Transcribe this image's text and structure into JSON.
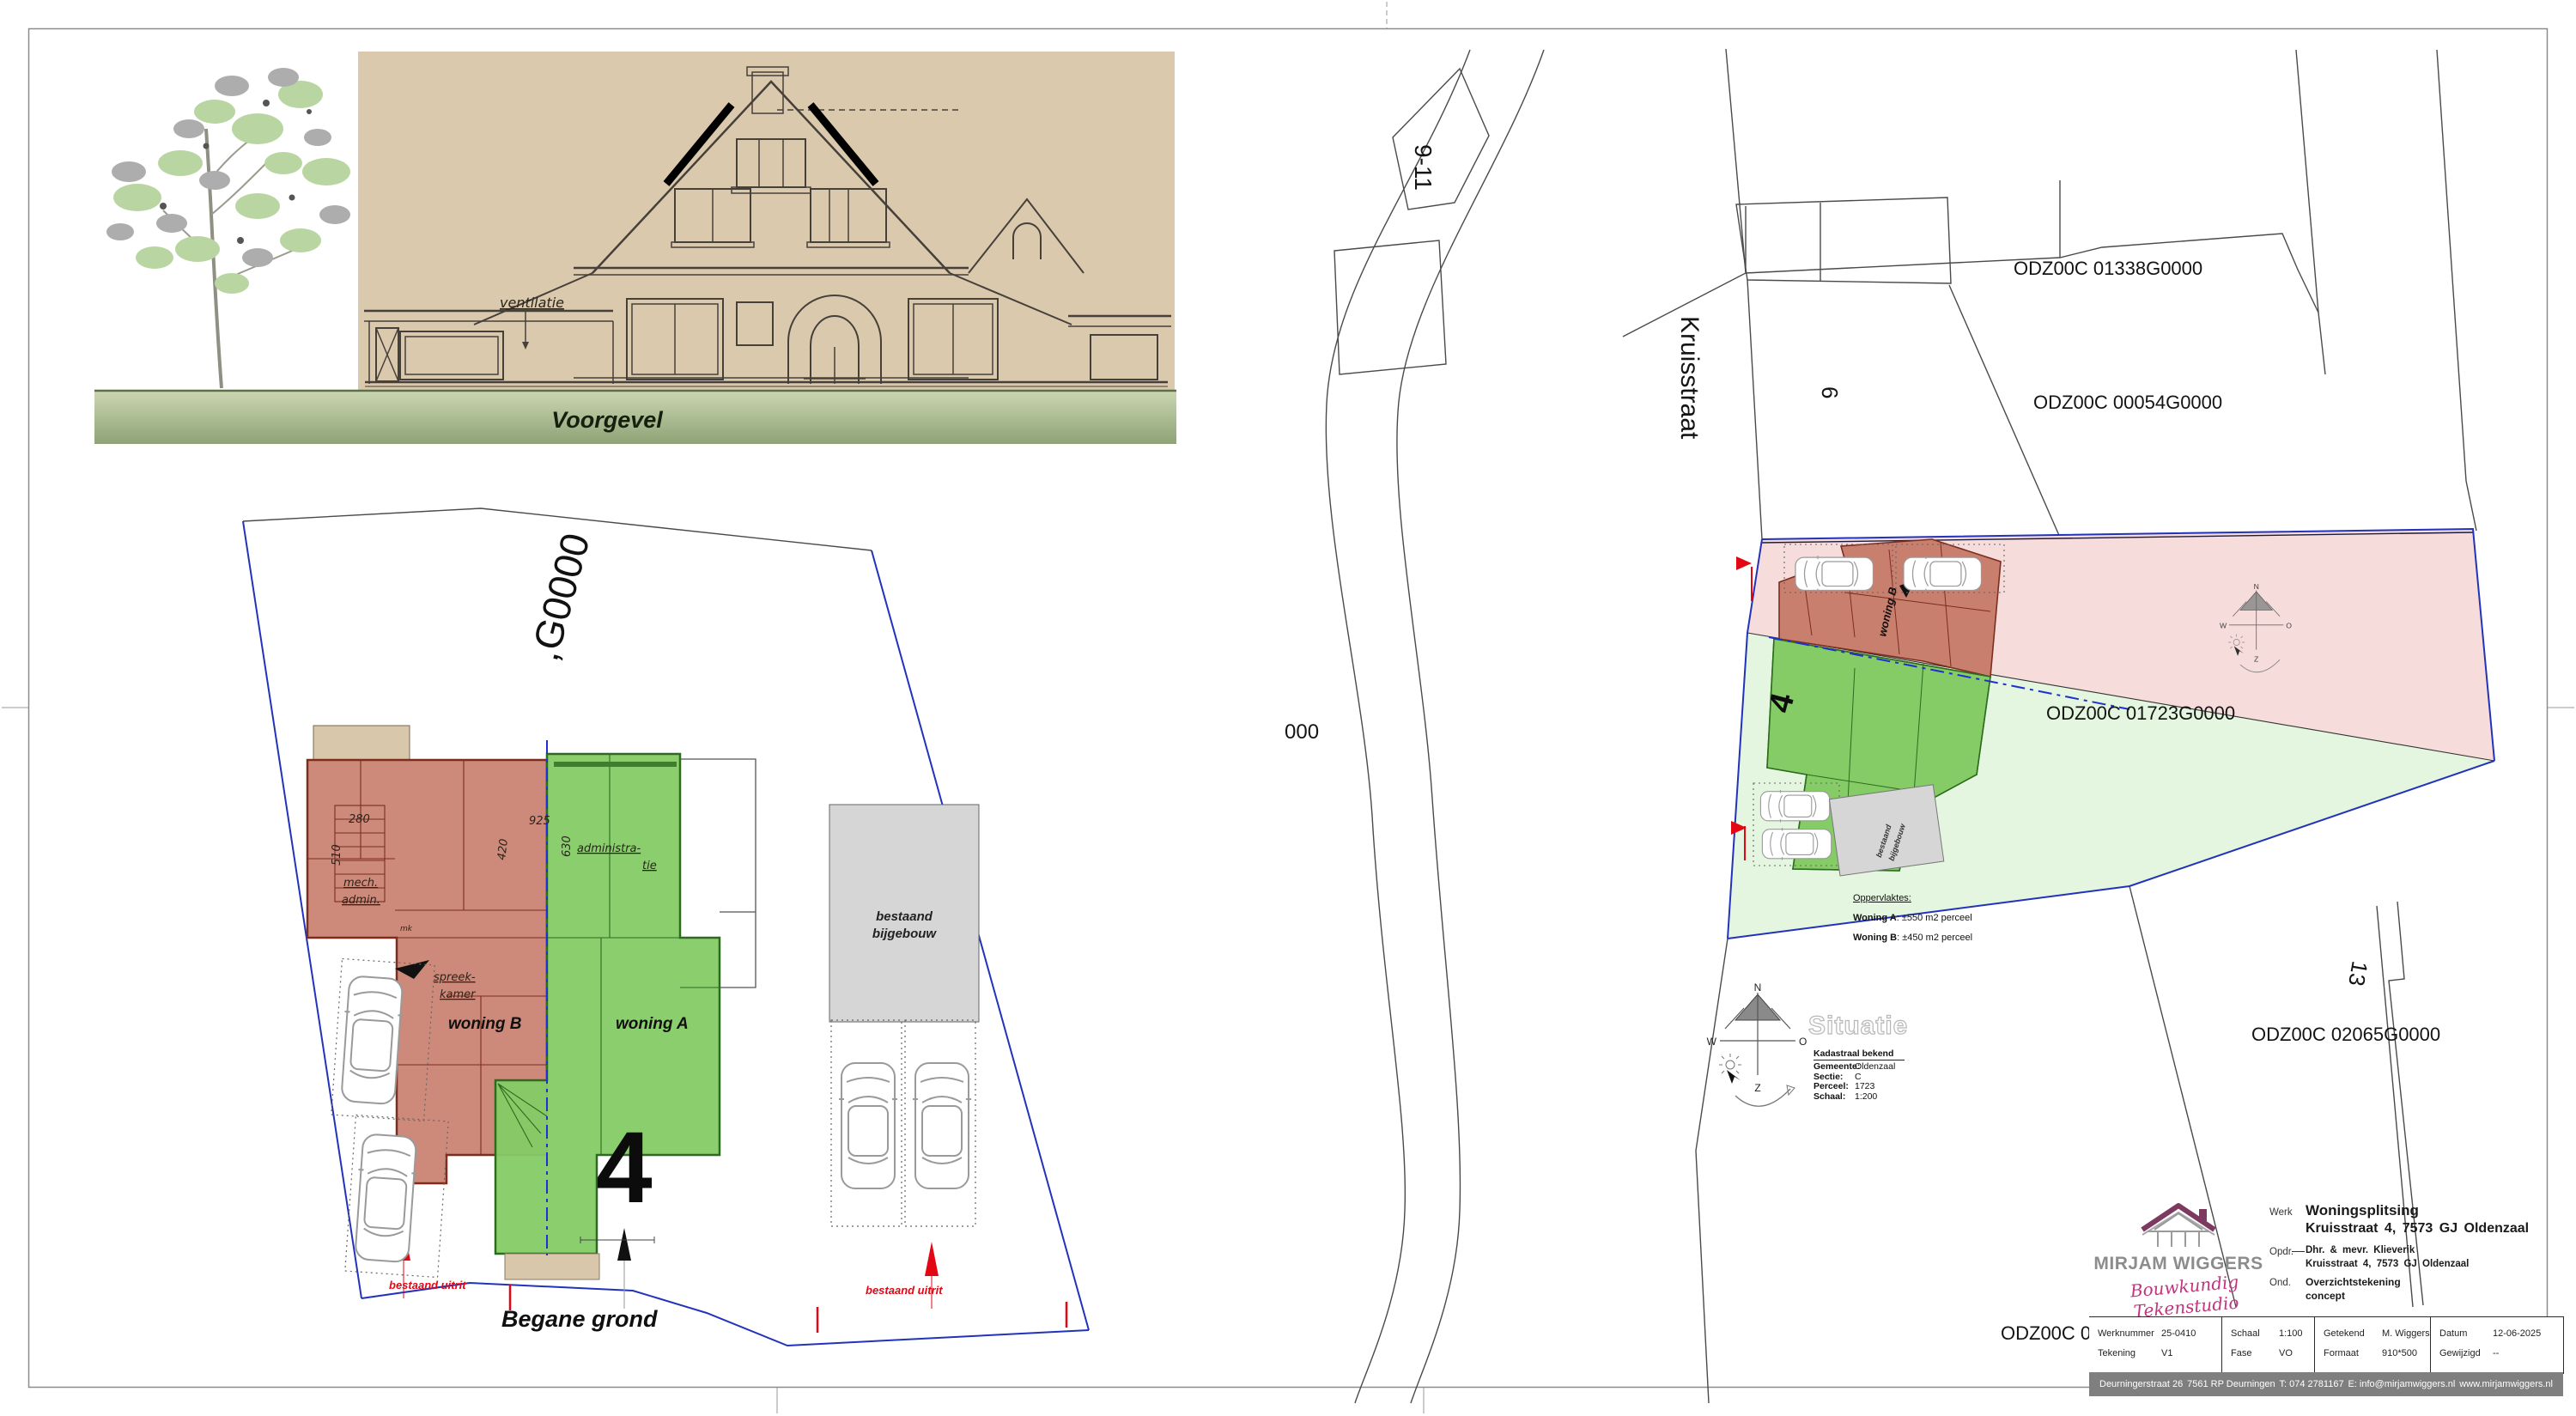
{
  "colors": {
    "paper_beige": "#dbc9ae",
    "ground_band_green": "#9fb386",
    "woning_a_green": "#85cb66",
    "woning_b_red": "#c97f6e",
    "parcel_pink": "#f7dcdc",
    "parcel_green": "#e4f6df",
    "boundary_blue": "#2233bb",
    "marker_red": "#e30613",
    "brand_maroon": "#7d3960",
    "brand_pink": "#c2347e",
    "footer_gray": "#7f7f7f"
  },
  "elevation": {
    "caption": "Voorgevel",
    "annotation": "ventilatie"
  },
  "floorplan": {
    "caption": "Begane grond",
    "house_number": "4",
    "woning_a": "woning A",
    "woning_b": "woning B",
    "uitrit": "bestaand uitrit",
    "parcel_partial": ",G0000",
    "bijgebouw_1": "bestaand",
    "bijgebouw_2": "bijgebouw",
    "rooms": {
      "mech_1": "mech.",
      "mech_2": "admin.",
      "spreek_1": "spreek-",
      "spreek_2": "kamer",
      "admin_1": "administra-",
      "admin_2": "tie",
      "mk": "mk"
    },
    "dims": {
      "d280": "280",
      "d510": "510",
      "d420": "420",
      "d925": "925",
      "d630": "630"
    }
  },
  "siteplan": {
    "watermark": "Situatie",
    "street": "Kruisstraat",
    "num_911": "9-11",
    "num_6": "6",
    "num_13": "13",
    "parcels": [
      "ODZ00C 01338G0000",
      "ODZ00C 00054G0000",
      "ODZ00C 01723G0000",
      "ODZ00C 02065G0000"
    ],
    "partial_bottom": "ODZ00C 0",
    "partial_left": "000",
    "house_number": "4",
    "woning_a": "woning A",
    "woning_b": "woning B",
    "bijgebouw_1": "bestaand",
    "bijgebouw_2": "bijgebouw",
    "areas": {
      "heading": "Oppervlaktes:",
      "a_label": "Woning A",
      "a_value": ": ±550 m2 perceel",
      "b_label": "Woning B",
      "b_value": ": ±450 m2 perceel"
    },
    "kadastraal": {
      "heading": "Kadastraal bekend",
      "rows": [
        {
          "label": "Gemeente:",
          "value": "Oldenzaal"
        },
        {
          "label": "Sectie:",
          "value": "C"
        },
        {
          "label": "Perceel:",
          "value": "1723"
        },
        {
          "label": "Schaal:",
          "value": "1:200"
        }
      ]
    },
    "compass": {
      "n": "N",
      "o": "O",
      "w": "W",
      "z": "Z"
    }
  },
  "titleblock": {
    "brand_name": "MIRJAM WIGGERS",
    "brand_tagline": "Bouwkundig Tekenstudio",
    "werk_label": "Werk",
    "werk_line1": "Woningsplitsing",
    "werk_line2": "Kruisstraat 4, 7573 GJ Oldenzaal",
    "opdr_label": "Opdr.",
    "opdr_line1": "Dhr. & mevr. Klieverik",
    "opdr_line2": "Kruisstraat 4, 7573 GJ Oldenzaal",
    "ond_label": "Ond.",
    "ond_line1": "Overzichtstekening",
    "ond_line2": "concept",
    "fields": [
      {
        "label": "Werknummer",
        "value": "25-0410"
      },
      {
        "label": "Tekening",
        "value": "V1"
      },
      {
        "label": "Schaal",
        "value": "1:100"
      },
      {
        "label": "Fase",
        "value": "VO"
      },
      {
        "label": "Getekend",
        "value": "M. Wiggers"
      },
      {
        "label": "Formaat",
        "value": "910*500"
      },
      {
        "label": "Datum",
        "value": "12-06-2025"
      },
      {
        "label": "Gewijzigd",
        "value": "--"
      }
    ],
    "footer": [
      "Deurningerstraat 26",
      "7561 RP Deurningen",
      "T: 074 2781167",
      "E: info@mirjamwiggers.nl",
      "www.mirjamwiggers.nl"
    ]
  }
}
